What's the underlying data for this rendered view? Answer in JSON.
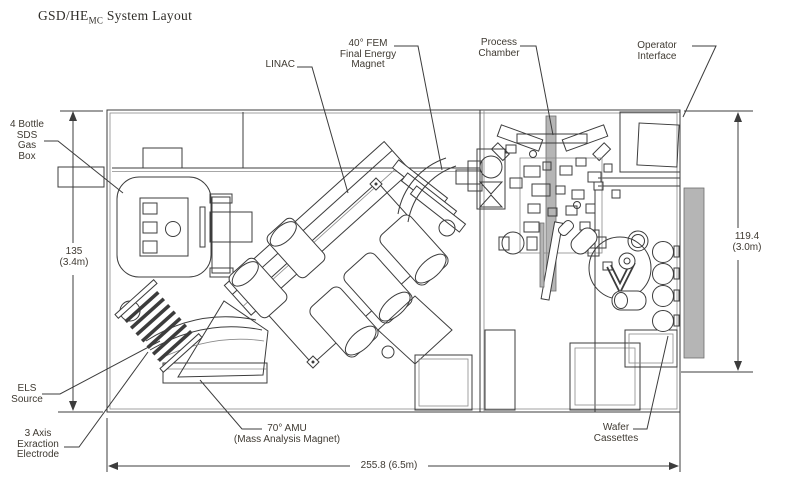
{
  "title": {
    "prefix": "GSD/HE",
    "subscript": "MC",
    "suffix": " System Layout"
  },
  "labels": {
    "gas_box": "4 Bottle\nSDS\nGas\nBox",
    "linac": "LINAC",
    "fem": "40° FEM\nFinal Energy\nMagnet",
    "process_chamber": "Process\nChamber",
    "operator_interface": "Operator\nInterface",
    "els_source": "ELS\nSource",
    "extraction_electrode": "3 Axis\nExraction\nElectrode",
    "amu": "70° AMU\n(Mass Analysis Magnet)",
    "wafer_cassettes": "Wafer\nCassettes"
  },
  "dimensions": {
    "left_height": "135\n(3.4m)",
    "right_height": "119.4\n(3.0m)",
    "bottom_width": "255.8 (6.5m)"
  },
  "colors": {
    "line": "#3c3c3c",
    "label_text": "#3f3a32",
    "gray_fill": "#b5b5b5",
    "background": "#ffffff"
  }
}
